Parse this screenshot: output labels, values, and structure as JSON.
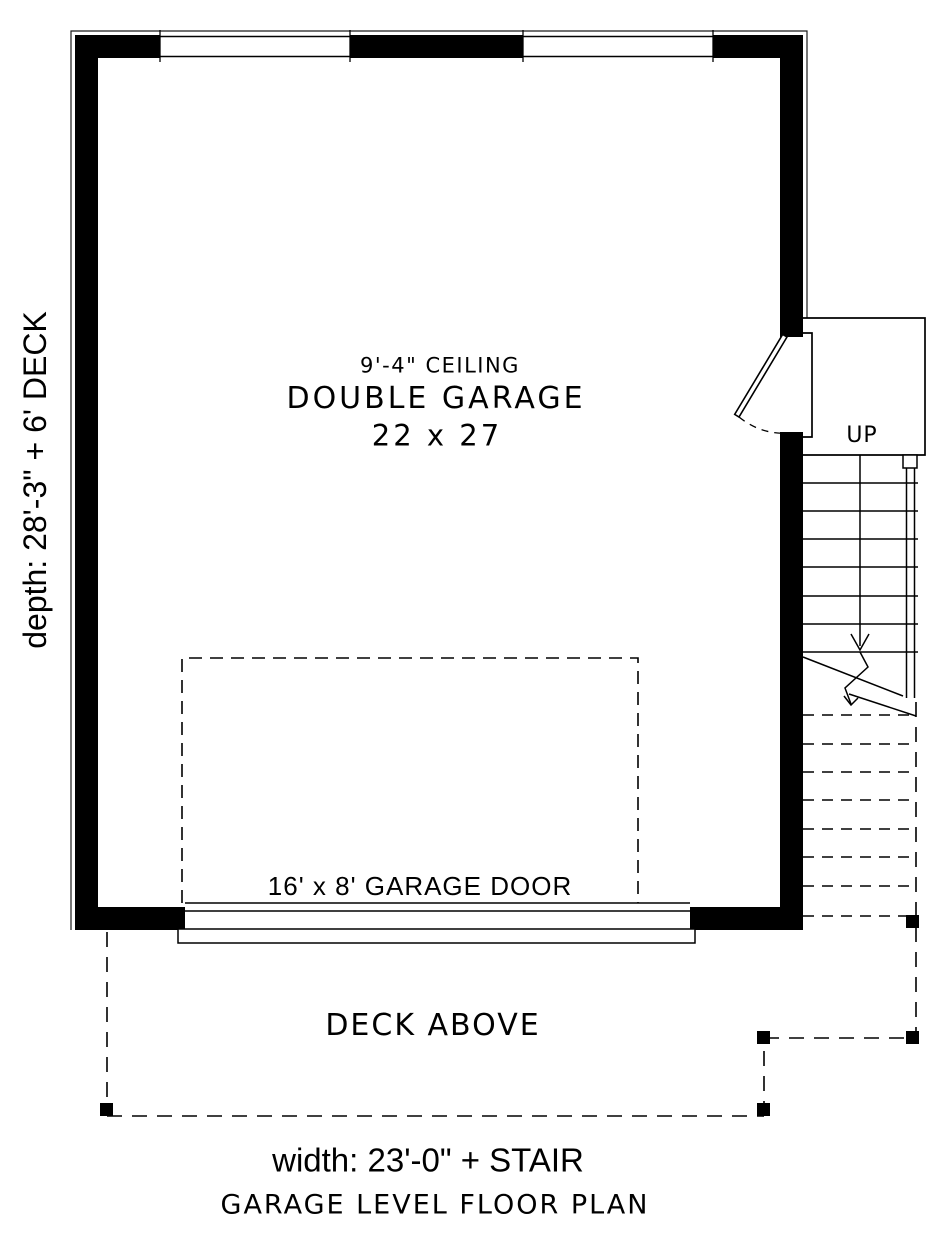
{
  "plan": {
    "room": {
      "ceiling": "9'-4\" CEILING",
      "name": "DOUBLE GARAGE",
      "size": "22 x 27"
    },
    "garage_door_label": "16' x 8' GARAGE DOOR",
    "deck_label": "DECK ABOVE",
    "stair": {
      "up_label": "UP"
    },
    "dimensions": {
      "depth": "depth: 28'-3\" + 6' DECK",
      "width": "width: 23'-0\" + STAIR"
    },
    "title": "GARAGE LEVEL FLOOR PLAN"
  },
  "colors": {
    "ink": "#000000",
    "paper": "#ffffff"
  }
}
